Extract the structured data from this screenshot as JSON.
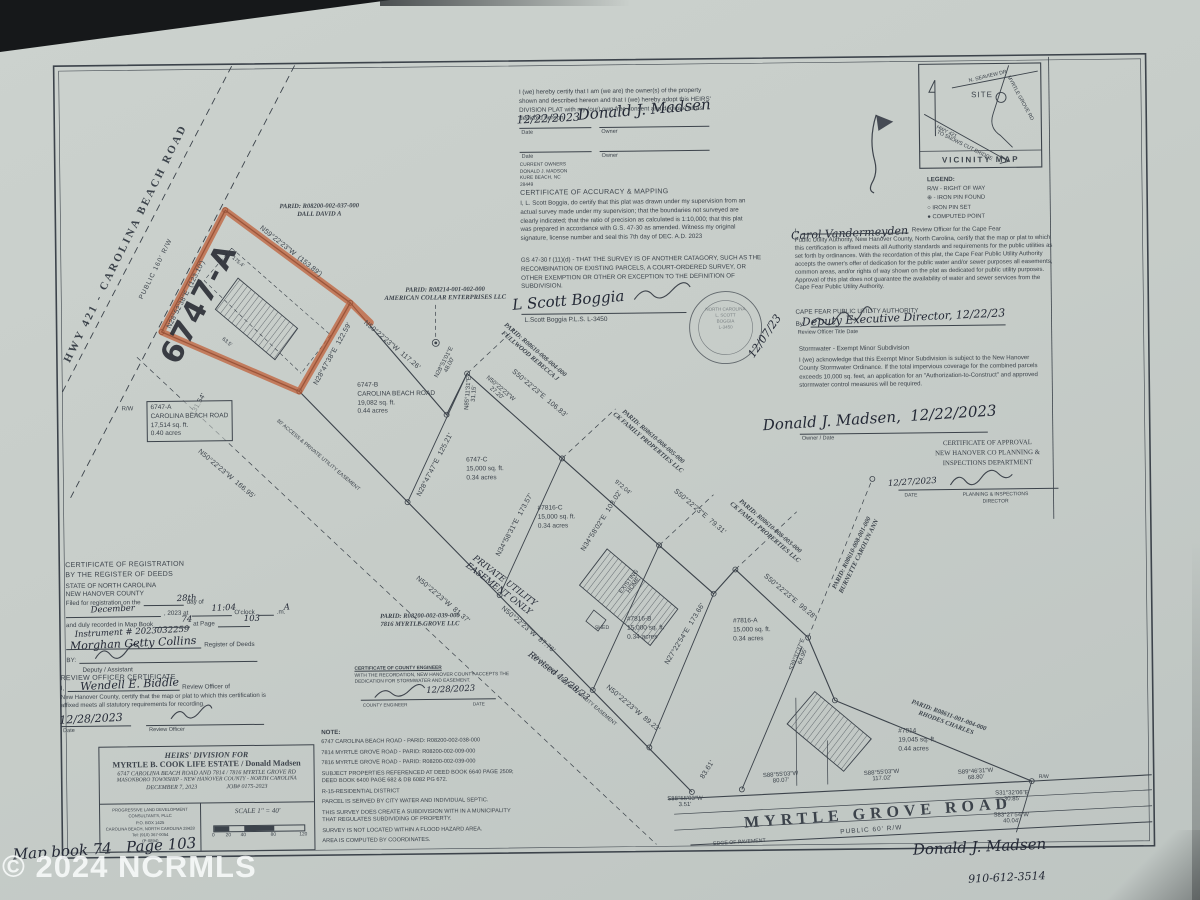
{
  "watermark": "© 2024 NCRMLS",
  "colors": {
    "highlight": "#bf5b33",
    "ink": "#3c434b",
    "paper": "#c9cfcb",
    "watermark_color": "#f8fbfa"
  },
  "owner_certificate": {
    "body": "I (we) hereby certify that I am (we are) the owner(s) of the property shown and described hereon and that I (we) hereby adopt this HEIRS' DIVISION PLAT with my (our) own free consent and dedicate all as depicted hereon.",
    "date_label": "Date",
    "owner_label": "Owner",
    "current_owners": "CURRENT OWNERS\nDONALD J. MADSON\nKURE BEACH, NC\n28449"
  },
  "accuracy_certificate": {
    "title": "CERTIFICATE OF ACCURACY & MAPPING",
    "body": "I, L. Scott Boggia, do certify that this plat was drawn under my supervision from an actual survey made under my supervision; that the boundaries not surveyed are clearly indicated; that the ratio of precision as calculated is 1:10,000; that this plat was prepared in accordance with G.S. 47-30 as amended. Witness my original signature, license number and seal this 7th day of DEC. A.D. 2023",
    "gs_note": "GS 47-30 f (11)(d) - THAT THE SURVEY IS OF ANOTHER CATAGORY, SUCH AS THE RECOMBINATION OF EXISTING PARCELS, A COURT-ORDERED SURVEY, OR OTHER EXEMPTION OR OTHER OR EXCEPTION TO THE DEFINITION OF SUBDIVISION.",
    "credential": "L.Scott Boggia P.L.S. L-3450",
    "seal_text": "NORTH CAROLINA\nL. SCOTT\nBOGGIA\nL-3450"
  },
  "utility_certificate": {
    "pre": "I,",
    "post": "Review Officer for the Cape Fear",
    "body": "Public Utility Authority, New Hanover County, North Carolina, certify that the map or plat to which this certification is affixed meets all Authority standards and requirements for the public utilities as set forth by ordinances. With the recordation of this plat, the Cape Fear Public Utility Authority accepts the owner's offer of dedication for the public water and/or sewer purposes all easements, common areas, and/or rights of way shown on the plat as dedicated for public utility purposes. Approval of this plat does not guarantee the availability of water and sewer services from the Cape Fear Public Utility Authority.",
    "authority": "CAPE FEAR PUBLIC UTILITY AUTHORITY",
    "by_label": "By:",
    "footer": "Review Officer   Title   Date"
  },
  "stormwater_certificate": {
    "title": "Stormwater - Exempt Minor Subdivision",
    "body": "I (we) acknowledge that this Exempt Minor Subdivision is subject to the New Hanover County Stormwater Ordinance. If the total impervious coverage for the combined parcels exceeds 10,000 sq. feet, an application for an \"Authorization-to-Construct\" and approved stormwater control measures will be required.",
    "footer": "Owner / Date"
  },
  "approval_certificate": {
    "title_lines": "CERTIFICATE OF APPROVAL\nNEW HANOVER CO PLANNING &\nINSPECTIONS DEPARTMENT",
    "date_label": "DATE",
    "director_label": "PLANNING & INSPECTIONS\nDIRECTOR"
  },
  "registration_certificate": {
    "title": "CERTIFICATE OF REGISTRATION\nBY THE REGISTER OF DEEDS",
    "state": "STATE OF NORTH CAROLINA",
    "county": "NEW HANOVER COUNTY",
    "l1a": "Filed for registration on the",
    "l1b": "day of",
    "l2a": ", 2023 at",
    "l2b": "O'clock",
    "l2c": ".m.",
    "l3a": "and duly recorded in Map Book",
    "l3b": "at Page",
    "register_label": "Register of Deeds",
    "by_label": "BY:",
    "deputy_label": "Deputy / Assistant"
  },
  "review_officer_certificate": {
    "title": "REVIEW OFFICER CERTIFICATE",
    "pre": "I,",
    "post": "Review Officer of",
    "body": "New Hanover County, certify that the map or plat to which this certification is affixed meets all statutory requirements for recording.",
    "date_label": "Date",
    "officer_label": "Review Officer"
  },
  "county_engineer_certificate": {
    "title": "CERTIFICATE OF COUNTY ENGINEER",
    "body": "WITH THE RECORDATION, NEW HANOVER COUNTY ACCEPTS THE DEDICATION FOR STORMWATER AND EASEMENT.",
    "footer_left": "COUNTY ENGINEER",
    "footer_right": "DATE"
  },
  "notes": {
    "heading": "NOTE:",
    "items": [
      "6747 CAROLINA BEACH ROAD - PARID: R08200-002-038-000",
      "7814 MYRTLE GROVE ROAD - PARID: R08200-002-009-000",
      "7816 MYRTLE GROVE ROAD - PARID: R08200-002-039-000",
      "SUBJECT PROPERTIES REFERENCED AT DEED BOOK 6640 PAGE 2509; DEED BOOK 6400 PAGE 682 & DB 6082 PG 672.",
      "R-15-RESIDENTIAL DISTRICT",
      "PARCEL IS SERVED BY CITY WATER AND INDIVIDUAL SEPTIC.",
      "THIS SURVEY DOES CREATE A SUBDIVISION WITH IN A MUNICIPALITY THAT REGULATES SUBDIVIDING OF PROPERTY.",
      "SURVEY IS NOT LOCATED WITHIN A FLOOD HAZARD AREA.",
      "AREA IS COMPUTED BY COORDINATES."
    ]
  },
  "title_block": {
    "line1": "HEIRS' DIVISION FOR",
    "line2": "MYRTLE B. COOK LIFE ESTATE / Donald Madsen",
    "line3": "6747 CAROLINA BEACH ROAD AND 7814 / 7816 MYRTLE GROVE RD",
    "line4": "MASONBORO TOWNSHIP - NEW HANOVER COUNTY - NORTH CAROLINA",
    "line5_date": "DECEMBER 7, 2023",
    "line5_job": "JOB# 0175-2023",
    "firm": "PROGRESSIVE LAND DEVELOPMENT CONSULTANTS, PLLC\nP.O. BOX 1425\nCAROLINA BEACH, NORTH CAROLINA 28428\nTel: (910) 367-0054\n(P-0894)",
    "scale_label": "SCALE 1\" = 40'",
    "scale_ticks": [
      {
        "t": "0",
        "x": 0
      },
      {
        "t": "20",
        "x": 15
      },
      {
        "t": "40",
        "x": 30
      },
      {
        "t": "80",
        "x": 60
      },
      {
        "t": "120",
        "x": 90
      }
    ]
  },
  "legend": {
    "title": "LEGEND:",
    "items": [
      "R/W - RIGHT OF WAY",
      "⊕ - IRON PIN FOUND",
      "○  IRON PIN SET",
      "●  COMPUTED POINT"
    ]
  },
  "parcels": [
    {
      "id": "6747-A",
      "lines": [
        "6747-A",
        "CAROLINA BEACH ROAD",
        "17,514 sq. ft.",
        "0.40 acres"
      ],
      "x": 147,
      "y": 396,
      "boxed": true
    },
    {
      "id": "6747-B",
      "lines": [
        "6747-B",
        "CAROLINA BEACH ROAD",
        "19,082 sq. ft.",
        "0.44 acres"
      ],
      "x": 358,
      "y": 379
    },
    {
      "id": "6747-C",
      "lines": [
        "6747-C",
        "15,000 sq. ft.",
        "0.34 acres"
      ],
      "x": 466,
      "y": 455
    },
    {
      "id": "7816-C",
      "lines": [
        "#7816-C",
        "15,000 sq. ft.",
        "0.34 acres"
      ],
      "x": 537,
      "y": 504
    },
    {
      "id": "7816-B",
      "lines": [
        "#7816-B",
        "15,000 sq. ft.",
        "0.34 acres"
      ],
      "x": 625,
      "y": 616
    },
    {
      "id": "7816-A",
      "lines": [
        "#7816-A",
        "15,000 sq. ft.",
        "0.34 acres"
      ],
      "x": 731,
      "y": 619
    },
    {
      "id": "7814",
      "lines": [
        "#7814",
        "19,045 sq. ft.",
        "0.44 acres"
      ],
      "x": 895,
      "y": 731
    }
  ],
  "plat": {
    "labels": [
      {
        "t": "HWY 421 - CAROLINA BEACH ROAD",
        "x": 128,
        "y": 238,
        "r": -63,
        "cls": "road-big",
        "n": "carolina-beach-road-label"
      },
      {
        "t": "PUBLIC 160' R/W",
        "x": 158,
        "y": 264,
        "r": -63,
        "cls": "road-small",
        "n": "carolina-beach-road-rw"
      },
      {
        "t": "N28°52'38\"E  (123.10')",
        "x": 188,
        "y": 290,
        "r": -62,
        "cls": "bearing"
      },
      {
        "t": "N59°22'23\"W  (153.89')",
        "x": 293,
        "y": 248,
        "r": 39,
        "cls": "bearing"
      },
      {
        "t": "N28°47'38\"E  122.59'",
        "x": 334,
        "y": 351,
        "r": -60,
        "cls": "bearing"
      },
      {
        "t": "131.54'",
        "x": 199,
        "y": 400,
        "r": -60,
        "cls": "bearing"
      },
      {
        "t": "N50°22'23\"W  166.95'",
        "x": 226,
        "y": 470,
        "r": 41,
        "cls": "bearing"
      },
      {
        "t": "N50°22'23\"W  117.26'",
        "x": 393,
        "y": 343,
        "r": 41,
        "cls": "bearing"
      },
      {
        "t": "N28°51'01\"E\n48.00'",
        "x": 448,
        "y": 362,
        "r": -62,
        "cls": "bearing-sm"
      },
      {
        "t": "N85°11'31\"E\n31.15'",
        "x": 472,
        "y": 392,
        "r": -85,
        "cls": "bearing-sm"
      },
      {
        "t": "N50°22'23\"W\n27.20'",
        "x": 499,
        "y": 390,
        "r": 41,
        "cls": "bearing-sm"
      },
      {
        "t": "N28°47'47\"E  125.21'",
        "x": 435,
        "y": 463,
        "r": -62,
        "cls": "bearing"
      },
      {
        "t": "S50°22'23\"E  106.83'",
        "x": 540,
        "y": 393,
        "r": 41,
        "cls": "bearing"
      },
      {
        "t": "N34°58'31\"E  173.57'",
        "x": 514,
        "y": 524,
        "r": -61,
        "cls": "bearing"
      },
      {
        "t": "N34°58'02\"E  103.02'",
        "x": 601,
        "y": 521,
        "r": -57,
        "cls": "bearing"
      },
      {
        "t": "972.04'",
        "x": 622,
        "y": 488,
        "r": 41,
        "cls": "bearing-sm"
      },
      {
        "t": "S50°22'23\"E  79.31'",
        "x": 699,
        "y": 513,
        "r": 41,
        "cls": "bearing"
      },
      {
        "t": "S50°22'23\"E  99.28'",
        "x": 788,
        "y": 599,
        "r": 41,
        "cls": "bearing"
      },
      {
        "t": "N27°22'54\"E  173.66'",
        "x": 683,
        "y": 635,
        "r": -58,
        "cls": "bearing"
      },
      {
        "t": "S39°37'37\"E\n64.95'",
        "x": 798,
        "y": 658,
        "r": -68,
        "cls": "bearing-sm"
      },
      {
        "t": "N50°22'23\"W  81.37'",
        "x": 441,
        "y": 598,
        "r": 41,
        "cls": "bearing"
      },
      {
        "t": "N50°22'23\"W  87.76'",
        "x": 526,
        "y": 629,
        "r": 41,
        "cls": "bearing"
      },
      {
        "t": "N50°22'23\"W  89.23'",
        "x": 630,
        "y": 709,
        "r": 41,
        "cls": "bearing"
      },
      {
        "t": "83.61'",
        "x": 704,
        "y": 771,
        "r": -57,
        "cls": "bearing"
      },
      {
        "t": "S88°55'03\"W\n80.07'",
        "x": 777,
        "y": 780,
        "r": -3,
        "cls": "bearing-sm"
      },
      {
        "t": "S88°55'03\"W\n3.51'",
        "x": 681,
        "y": 803,
        "r": 0,
        "cls": "bearing-sm"
      },
      {
        "t": "S88°55'03\"W\n117.02'",
        "x": 878,
        "y": 779,
        "r": -3,
        "cls": "bearing-sm"
      },
      {
        "t": "S89°46'31\"W\n68.80'",
        "x": 972,
        "y": 779,
        "r": -3,
        "cls": "bearing-sm"
      },
      {
        "t": "S31°32'06\"E\n30.85'",
        "x": 1008,
        "y": 801,
        "r": 0,
        "cls": "bearing-sm"
      },
      {
        "t": "S83°27'54\"W\n40.04'",
        "x": 1007,
        "y": 823,
        "r": 0,
        "cls": "bearing-sm"
      },
      {
        "t": "30' ACCESS & PRIVATE UTILITY EASEMENT",
        "x": 318,
        "y": 452,
        "r": 41,
        "cls": "tinyl"
      },
      {
        "t": "30' ACCESS & PRIVATE UTILITY EASEMENT",
        "x": 572,
        "y": 690,
        "r": 41,
        "cls": "tinyl"
      },
      {
        "t": "PRIVATE UTILITY\nEASEMENT ONLY",
        "x": 500,
        "y": 584,
        "r": 38,
        "cls": "hand-sm"
      },
      {
        "t": "Revised 12/28/23",
        "x": 556,
        "y": 676,
        "r": 38,
        "cls": "hand-sm"
      },
      {
        "t": "175.4'",
        "x": 240,
        "y": 258,
        "r": 41,
        "cls": "tinyl"
      },
      {
        "t": "63.5'",
        "x": 228,
        "y": 338,
        "r": 41,
        "cls": "tinyl"
      },
      {
        "t": "R/W",
        "x": 128,
        "y": 404,
        "r": 0,
        "cls": "bearing-sm"
      },
      {
        "t": "R/W",
        "x": 1040,
        "y": 782,
        "r": 0,
        "cls": "tinyl"
      },
      {
        "t": "EDGE OF PAVEMENT",
        "x": 735,
        "y": 844,
        "r": -3,
        "cls": "tinyl"
      },
      {
        "t": "SHED",
        "x": 600,
        "y": 628,
        "r": 0,
        "cls": "tinyl"
      },
      {
        "t": "EXISTING\nHOME",
        "x": 630,
        "y": 584,
        "r": -52,
        "cls": "bearing-sm"
      },
      {
        "t": "MYRTLE GROVE ROAD",
        "x": 874,
        "y": 817,
        "r": -3.5,
        "cls": "mgr-big",
        "n": "myrtle-grove-road-label"
      },
      {
        "t": "PUBLIC 60' R/W",
        "x": 867,
        "y": 833,
        "r": -3.5,
        "cls": "road-small",
        "n": "myrtle-grove-road-rw"
      },
      {
        "t": "6747-A",
        "x": 201,
        "y": 299,
        "r": -62,
        "cls": "big-hand",
        "n": "handwritten-parcel-id"
      },
      {
        "t": "PARID: R08200-002-037-000\nDALL DAVID A",
        "x": 322,
        "y": 208,
        "r": 0,
        "cls": "parid"
      },
      {
        "t": "PARID: R08214-001-002-000\nAMERICAN COLLAR ENTERPRISES LLC",
        "x": 447,
        "y": 293,
        "r": 0,
        "cls": "parid"
      },
      {
        "t": "PARID: R08610-008-004-000\nFULLWOOD REBECCA J",
        "x": 533,
        "y": 353,
        "r": 41,
        "cls": "parid"
      },
      {
        "t": "PARID: R08610-008-005-000\nCK FAMILY PROPERTIES LLC",
        "x": 650,
        "y": 441,
        "r": 41,
        "cls": "parid"
      },
      {
        "t": "PARID: R08610-008-003-000\nCK FAMILY PROPERTIES LLC",
        "x": 766,
        "y": 532,
        "r": 41,
        "cls": "parid"
      },
      {
        "t": "PARID: R08610-008-001-000\nBURNETTE CAROLYN ANN",
        "x": 855,
        "y": 558,
        "r": -63,
        "cls": "parid"
      },
      {
        "t": "PARID: R08611-001-004-000\nRHODES CHARLES",
        "x": 944,
        "y": 724,
        "r": 21,
        "cls": "parid"
      },
      {
        "t": "PARID: R08200-002-039-000\n7816 MYRTLE GROVE LLC",
        "x": 418,
        "y": 619,
        "r": 0,
        "cls": "parid"
      },
      {
        "t": "12/07/23",
        "x": 766,
        "y": 338,
        "r": -55,
        "cls": "hand-md"
      },
      {
        "t": "Donald J. Madsen",
        "x": 975,
        "y": 851,
        "r": -2,
        "cls": "hand-lg",
        "n": "handwritten-owner-name"
      },
      {
        "t": "910-612-3514",
        "x": 1002,
        "y": 882,
        "r": -2,
        "cls": "hand-md"
      },
      {
        "t": "Map book 74   Page 103",
        "x": 100,
        "y": 843,
        "r": -3,
        "cls": "hand-lg",
        "n": "handwritten-map-book-note"
      },
      {
        "t": "N. SEAVIEW DR",
        "x": 992,
        "y": 81,
        "r": -13,
        "cls": "tinyl"
      },
      {
        "t": "MYRTLE GROVE RD",
        "x": 1024,
        "y": 103,
        "r": 62,
        "cls": "tinyl"
      },
      {
        "t": "SITE",
        "x": 986,
        "y": 99,
        "r": 0,
        "cls": "site-lbl",
        "n": "vicinity-site-label"
      },
      {
        "t": "HWY 421",
        "x": 950,
        "y": 136,
        "r": 27,
        "cls": "tinyl"
      },
      {
        "t": "TO SNOWS CUT BRIDGE",
        "x": 968,
        "y": 150,
        "r": 27,
        "cls": "tinyl"
      },
      {
        "t": "VICINITY MAP",
        "x": 984,
        "y": 164,
        "r": 0,
        "cls": "vmap-lbl",
        "n": "vicinity-map-caption"
      },
      {
        "t": "28th",
        "x": 185,
        "y": 594,
        "r": -2,
        "cls": "hand-sm",
        "n": "reg-fill-day"
      },
      {
        "t": "December",
        "x": 111,
        "y": 604,
        "r": -2,
        "cls": "hand-sm",
        "n": "reg-fill-month"
      },
      {
        "t": "11:04",
        "x": 222,
        "y": 604,
        "r": -2,
        "cls": "hand-sm",
        "n": "reg-fill-time"
      },
      {
        "t": "A",
        "x": 285,
        "y": 604,
        "r": 0,
        "cls": "hand-sm",
        "n": "reg-fill-ampm"
      },
      {
        "t": "74",
        "x": 185,
        "y": 615,
        "r": 0,
        "cls": "hand-sm",
        "n": "reg-fill-book"
      },
      {
        "t": "103",
        "x": 250,
        "y": 615,
        "r": 0,
        "cls": "hand-sm",
        "n": "reg-fill-page"
      },
      {
        "t": "Instrument # 2023032259",
        "x": 130,
        "y": 627,
        "r": -2,
        "cls": "hand-sm",
        "n": "reg-fill-instrument"
      },
      {
        "t": "Morghan Getty Collins",
        "x": 131,
        "y": 638,
        "r": -2,
        "cls": "hand-md",
        "n": "reg-register-name"
      },
      {
        "t": "Wendell E. Biddle",
        "x": 127,
        "y": 679,
        "r": -2,
        "cls": "hand-md",
        "n": "review-fill-name"
      },
      {
        "t": "12/28/2023",
        "x": 88,
        "y": 713,
        "r": -2,
        "cls": "hand-md",
        "n": "review-fill-date"
      },
      {
        "t": "12/28/2023",
        "x": 448,
        "y": 688,
        "r": -2,
        "cls": "hand-sm",
        "n": "engineer-fill-date"
      },
      {
        "t": "12/27/2023",
        "x": 912,
        "y": 486,
        "r": -3,
        "cls": "hand-sm",
        "n": "approval-fill-date"
      },
      {
        "t": "12/22/2023",
        "x": 552,
        "y": 118,
        "r": -2,
        "cls": "hand-md",
        "n": "owner-cert-date"
      },
      {
        "t": "Donald J. Madsen",
        "x": 648,
        "y": 110,
        "r": -4,
        "cls": "hand-lg",
        "n": "owner-cert-signature"
      },
      {
        "t": "Donald J. Madsen,  12/22/2023",
        "x": 880,
        "y": 421,
        "r": -3,
        "cls": "hand-lg",
        "n": "stormwater-signature"
      },
      {
        "t": "Carol Vandermeyden",
        "x": 852,
        "y": 236,
        "r": -2,
        "cls": "hand-md",
        "n": "utility-officer-name"
      },
      {
        "t": "Deputy Executive Director, 12/22/23",
        "x": 905,
        "y": 321,
        "r": -2,
        "cls": "hand-md",
        "n": "utility-by-title"
      },
      {
        "t": "L Scott Boggia",
        "x": 570,
        "y": 300,
        "r": -4,
        "cls": "hand-lg",
        "n": "surveyor-signature"
      }
    ]
  }
}
